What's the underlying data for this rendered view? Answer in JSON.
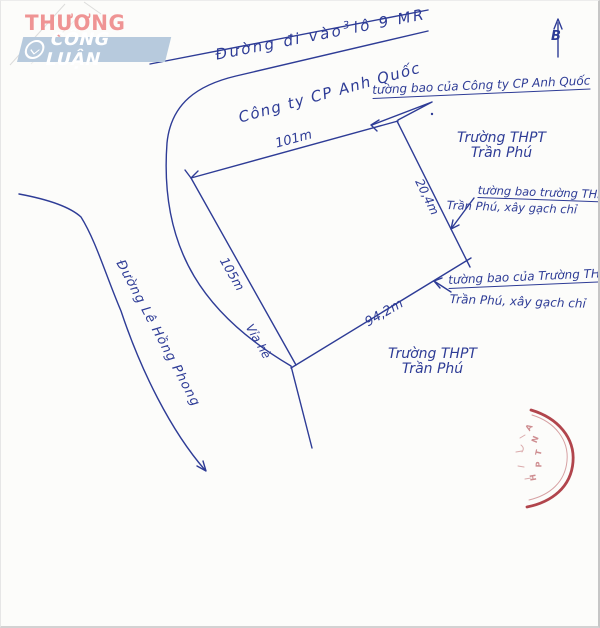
{
  "watermark": {
    "line1": "THƯƠNG HIỆU",
    "line2": "CÔNG LUẬN"
  },
  "compass": {
    "north_label": "B"
  },
  "top_road": {
    "label_pre": "Đường đi vào",
    "label_sup": "3",
    "label_post": "lô 9 MR"
  },
  "left_road": {
    "name": "Đường Lê Hồng Phong",
    "sidewalk": "Vỉa hè"
  },
  "parcel": {
    "owner_label": "Công ty CP Anh Quốc",
    "dim_top": "101m",
    "dim_left": "105m",
    "dim_right": "20,4m",
    "dim_bottom": "94,2m"
  },
  "school": {
    "right_line1": "Trường THPT",
    "right_line2": "Trần Phú",
    "bottom_line1": "Trường THPT",
    "bottom_line2": "Trần Phú"
  },
  "annotations": {
    "company_wall": "tường bao của Công ty CP Anh Quốc",
    "school_wall_upper_line1": "tường bao trường THPT,",
    "school_wall_upper_line2": "Trần Phú, xây gạch chỉ",
    "school_wall_lower_line1": "tường bao của Trường THPT",
    "school_wall_lower_line2": "Trần Phú, xây gạch chỉ"
  },
  "stamp": {
    "letters": [
      "A",
      "N",
      "T",
      "P",
      "H"
    ]
  },
  "colors": {
    "ink": "#2e3c96",
    "stamp_red": "#a93138",
    "logo_pink": "#ef8f8f",
    "logo_blue": "#b7cadd"
  }
}
